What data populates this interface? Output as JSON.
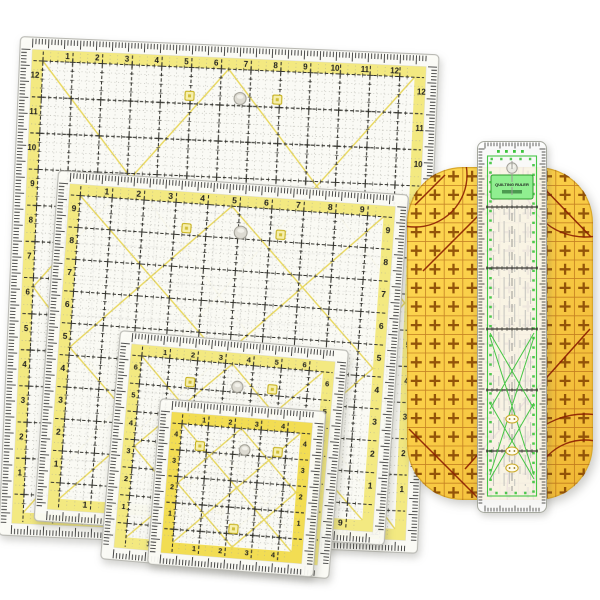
{
  "background_color": "#ffffff",
  "square_rulers": [
    {
      "name": "quilting-ruler-12in",
      "numbers": [
        "1",
        "2",
        "3",
        "4",
        "5",
        "6",
        "7",
        "8",
        "9",
        "10",
        "11",
        "12"
      ],
      "band_color": "#f3e87d"
    },
    {
      "name": "quilting-ruler-9in",
      "numbers": [
        "1",
        "2",
        "3",
        "4",
        "5",
        "6",
        "7",
        "8",
        "9"
      ],
      "band_color": "#f3e87d"
    },
    {
      "name": "quilting-ruler-6in",
      "numbers": [
        "1",
        "2",
        "3",
        "4",
        "5",
        "6"
      ],
      "band_color": "#f3e87d"
    },
    {
      "name": "quilting-ruler-4in",
      "numbers": [
        "1",
        "2",
        "3",
        "4"
      ],
      "band_color": "#f1dc4d"
    }
  ],
  "ironing_ruler": {
    "name": "hot-ironing-ruler",
    "cross_glyph": "+",
    "body_color_light": "#ffdb55",
    "body_color_dark": "#efb634",
    "marking_color": "#8a4a04",
    "line_color": "#8c1f02"
  },
  "strip_ruler": {
    "name": "quilting-strip-ruler",
    "label": "QUILTING RULER",
    "green_color": "#3dc43d",
    "badge_color": "#c7a41a"
  },
  "shared": {
    "grid_color": "#32322c",
    "tick_color": "#1c1c1c",
    "diagonal_color": "#e7d44b",
    "body_color": "#fdfdf7"
  },
  "icons": {
    "hang-hole": "circle",
    "brand-logo": "square",
    "cross-mark": "+"
  }
}
